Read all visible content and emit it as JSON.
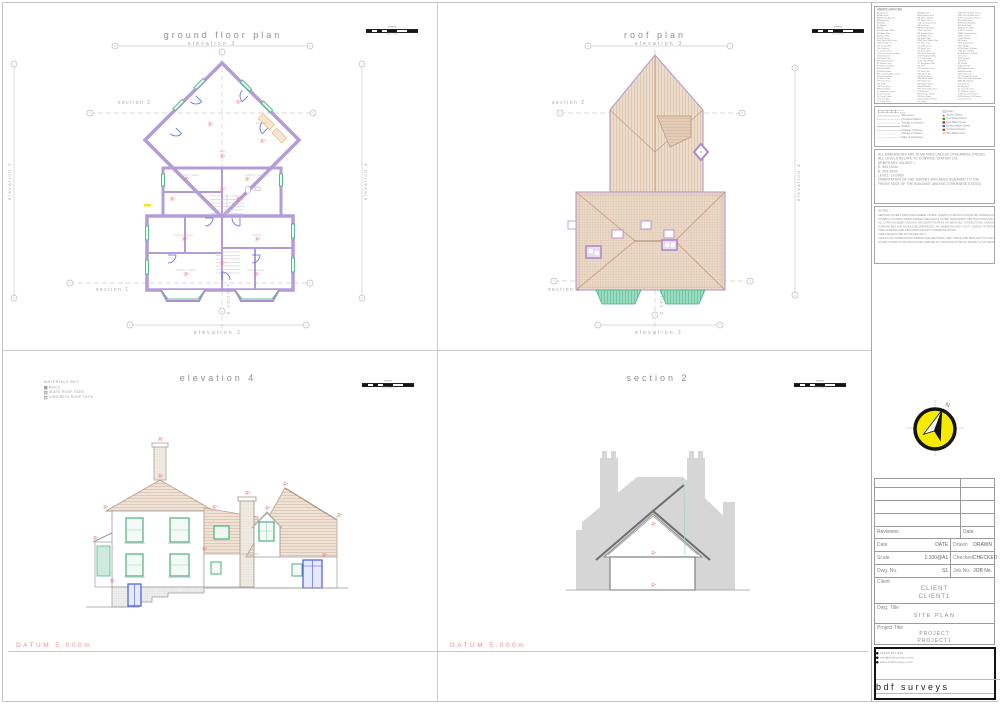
{
  "labels": {
    "ground_floor_plan": "ground floor plan",
    "roof_plan": "roof plan",
    "elevation4_title": "elevation 4",
    "section2_title": "section 2",
    "elevation1": "elevation 1",
    "elevation2": "elevation 2",
    "elevation3": "elevation 3",
    "elevation4": "elevation 4",
    "section1": "section 1",
    "section2": "section 2",
    "section3": "section 3",
    "datum": "DATUM 5.000m"
  },
  "scale_bar": {
    "unit": "metres",
    "ticks": "0 1 2 3 4 5"
  },
  "rooms": [
    "hall",
    "dining room",
    "sitting room",
    "kitchen",
    "living room",
    "study",
    "family room",
    "play room"
  ],
  "materials_key": {
    "title": "MATERIALS KEY",
    "items": [
      {
        "label": "BRICK",
        "style": "background:#b2aa9e"
      },
      {
        "label": "SLATE ROOF TILES",
        "style": "background:#d8d2ca"
      },
      {
        "label": "CONCRETE ROOF TILES",
        "style": "background:#eae4dc"
      }
    ]
  },
  "title_block": {
    "abbreviations": {
      "title": "ABBREVIATIONS",
      "col1": [
        "AD  Air Duct",
        "AV  Air Valve",
        "BB  Belisha Beacon",
        "BH  Borehole",
        "BK  Brick",
        "BL  Bollard",
        "BN  Bin",
        "BO  Blocked Outlet",
        "BP  Base Plate",
        "BS  Bus Stop",
        "BT  BT Cover",
        "BWL Back Wall Level",
        "CATV Cable TV",
        "CB  Control Box",
        "CH  Chimney",
        "CL  Cover Level",
        "CPS Conc Paving Slabs",
        "DK  Drop Kerb",
        "DP  Down Pipe",
        "EB  Electricity Box",
        "EL  Eaves Level",
        "EP  Electricity Pole",
        "ER  Earth Rod",
        "FB  Flower Bed",
        "FFL Finished Floor Level",
        "FH  Fire Hydrant",
        "FL  Floor Level",
        "GP  Gate Post",
        "GU  Gully",
        "GV  Gas Valve",
        "HR  Hand Rail",
        "IC  Inspection Cover",
        "IL  Invert Level",
        "KO  Kerb Outlet",
        "LB  Letter Box",
        "LP  Lamp Post"
      ],
      "col2": [
        "MH  Manhole",
        "MKR Marker Post",
        "NB  Notice Board",
        "NP  Name Plate",
        "OHL Overhead Line",
        "PB  Post Box",
        "PM  Parking Meter",
        "PW  Party Wall",
        "RE  Rodding Eye",
        "RL  Ridge Level",
        "RS  Road Sign",
        "RWP Rain Water Pipe",
        "SC  Stop Cock",
        "SL  Soffit Level",
        "SP  Sign Post",
        "SV  Stop Valve",
        "SVP Soil Vent Pipe",
        "TCB Telephone Box",
        "TL  Traffic Light",
        "TOW Top Of Wall",
        "TP  Telegraph Pole",
        "TR  Tree",
        "UTL Unable To Lift",
        "VP  Vent Pipe",
        "WB  Waste Bin",
        "WL  Water Level",
        "WM  Water Meter",
        "WO  Wash Out",
        "WV  Water Valve",
        "WDW Window",
        "THL Threshold Level",
        "STN Station",
        "SW  Surface Water",
        "FW  Foul Water",
        "CW  Combined Water",
        "GY  Gully"
      ],
      "col3": [
        "PWF Post & Wire Fence",
        "PRF Post & Rail Fence",
        "CBF Close Board Fence",
        "IR  Iron Railings",
        "RW  Retaining Wall",
        "BW  Brick Wall",
        "SNW Stone Wall",
        "CONC Concrete",
        "TMAC Tarmacadam",
        "GRVL Gravel",
        "COB Cobbles",
        "GR  Grass",
        "VEG Vegetation",
        "HDG Hedge",
        "EOW Edge Of Water",
        "TOB Top Of Bank",
        "BOB Bottom Of Bank",
        "CR  Crown",
        "SPR Spread",
        "GIR Girth",
        "HT  Height",
        "DIA Diameter",
        "APX Approximate",
        "ASS Assumed",
        "OBS Obscured",
        "UTT Unable To Trace",
        "NVD No Visible Drainage",
        "ABD Abandoned",
        "DIS Disused",
        "EX  Existing",
        "GL  Ground Level",
        "PL  Platform Level",
        "TOW Top Of Window",
        "BOW Bottom Of Window",
        "CILL Cill Level"
      ]
    },
    "legend": {
      "fence_top": "Top",
      "fence_bottom": "Bottom",
      "lines": [
        {
          "label": "Wire Fence",
          "style": "border-top:1px solid #999"
        },
        {
          "label": "Overhead Cables",
          "style": "border-top:1px dashed #999"
        },
        {
          "label": "Change in Direction",
          "style": "border-top:1px dotted #999"
        },
        {
          "label": "Kerbline",
          "style": "border-top:2px solid #b0b0b0"
        },
        {
          "label": "Drainage Channel",
          "style": "border-top:1px dashed #777"
        },
        {
          "label": "Change in Surface",
          "style": "border-top:1px dotted #bbb"
        },
        {
          "label": "Edge of Vegetation",
          "style": "border-top:1px dashed #aaa"
        }
      ],
      "symbols": [
        {
          "label": "Gate",
          "style": "background:#fff;border:1px solid #777;height:4px;width:9px"
        },
        {
          "label": "Survey Station",
          "style": "background:#d83030;clip-path:polygon(50% 0,100% 100%,0 100%)"
        },
        {
          "label": "Tree Study/Stump",
          "style": "background:#28a028"
        },
        {
          "label": "Foul Water Sewer",
          "style": "background:#c03828"
        },
        {
          "label": "Surface Water Sewer",
          "style": "background:#4868d8"
        },
        {
          "label": "Combined Sewer",
          "style": "background:#8a4a28"
        },
        {
          "label": "Rain Water Gully",
          "style": "background:#f2c8c8"
        }
      ]
    },
    "dimension_notes": [
      "ALL DIMENSIONS ARE IN METRES UNLESS OTHERWISE STATED.",
      "ALL LEVELS RELATE TO CONTROL STATION 101",
      "",
      "ARBITRARY VALUES =",
      "E: 500.000m",
      "N: 200.000m",
      "LEVEL: 10.000m",
      "",
      "ORIENTATION OF THE SURVEY HAS BEEN SQUARED TO THE",
      "FRONT FACE OF THE BUILDING UNLESS OTHERWISE STATED"
    ],
    "notes": {
      "title": "NOTES :-",
      "lines": [
        "SERVICE COVERS INDICATED WHERE VISIBLE. INVERTS & DETAILS SURVEYED WHERE ACCESS PERMITS.",
        "COVERS LOCATED UNDER PARKED VEHICLES & OTHER TEMPORARY OBSTRUCTIONS MAY BE OMITTED.",
        "ALL CARE HAS BEEN TAKEN IN THE IDENTIFICATION OF SERVICES, CONNECTIONS CANNOT BE",
        "GUARANTEED AND SHOULD BE VERIFIED BY AN UNDERGROUND UTILITY SURVEY IF CRITICAL.",
        "",
        "TREE SPREADS ARE INDICATED UNLESS OTHERWISE NOTED.",
        "TREE HEIGHTS ARE ESTIMATED ONLY.",
        "SHOULD ANY DIMENSIONAL ERRORS BE IDENTIFIED THEY SHOULD BE BROUGHT TO THE ATTENTION",
        "OF BDF SURVEYS AND SHOULD BE VERIFIED BY A SPECIALIST DETAIL SURVEY IF SO DESIRED."
      ]
    },
    "revisions": {
      "left": "Revisions",
      "right": "Date"
    },
    "fields": {
      "date_label": "Date",
      "date": "DATE",
      "drawn_label": "Drawn",
      "drawn": "DRAWN",
      "scale_label": "Scale",
      "scale": "1:100@A1",
      "checked_label": "Checked",
      "checked": "CHECKED",
      "dwg_label": "Dwg. No.",
      "dwg": "S1",
      "job_label": "Job No.",
      "job": "JOB No."
    },
    "client": {
      "label": "Client",
      "line1": "CLIENT",
      "line2": "CLIENT1"
    },
    "dwg_title": {
      "label": "Dwg. Title",
      "value": "SITE PLAN"
    },
    "project": {
      "label": "Project Title",
      "line1": "PROJECT",
      "line2": "PROJECT1"
    },
    "compass": {
      "n": "N"
    },
    "logo": {
      "phone": "01234 567 890",
      "email": "info@bdfsurveys.com",
      "web": "www.bdfsurveys.com",
      "name": "bdf surveys",
      "tagline": "TOPOGRAPHICAL | MEASURED BUILDING | UTILITY SURVEYS",
      "emblem": "RICS"
    }
  }
}
